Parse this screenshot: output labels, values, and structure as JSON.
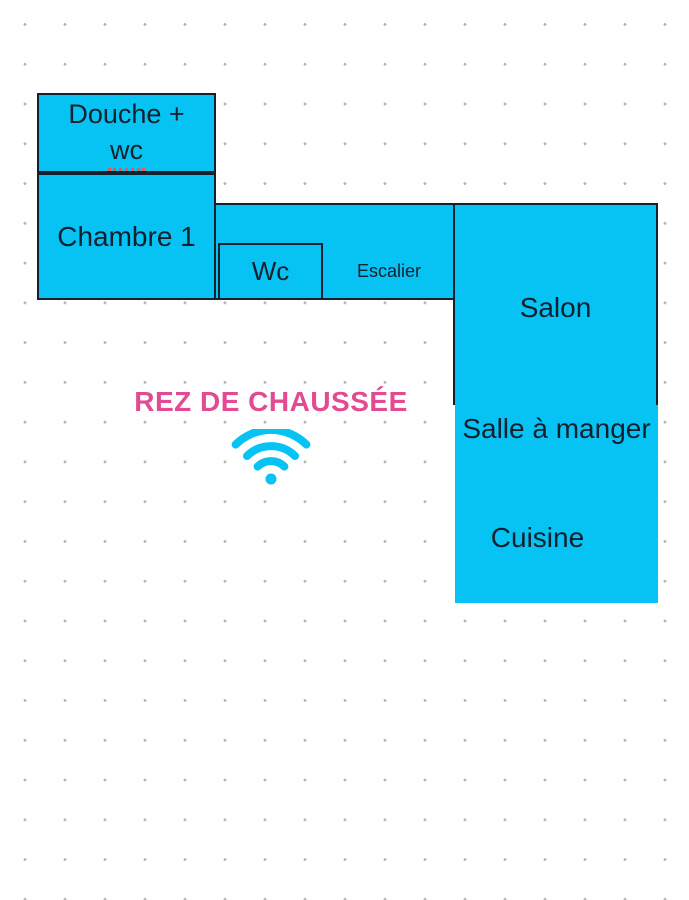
{
  "title": {
    "text": "REZ DE CHAUSSÉE"
  },
  "rooms": {
    "douche_wc": {
      "line1": "Douche +",
      "line2": "wc"
    },
    "chambre1": {
      "label": "Chambre 1"
    },
    "wc": {
      "label": "Wc"
    },
    "escalier": {
      "label": "Escalier"
    },
    "salon": {
      "label": "Salon"
    },
    "salle_a_manger": {
      "label": "Salle à manger"
    },
    "cuisine": {
      "label": "Cuisine"
    }
  },
  "icons": {
    "wifi": "wifi-icon"
  },
  "colors": {
    "room_fill": "#06c3f3",
    "room_border": "#13202e",
    "room_text": "#13202e",
    "title_pink": "#e24b92",
    "misspell_underline": "#e05b5b",
    "dot_grid_gray": "#b4b4b4",
    "background": "#ffffff",
    "wifi_icon": "#06c3f3"
  }
}
